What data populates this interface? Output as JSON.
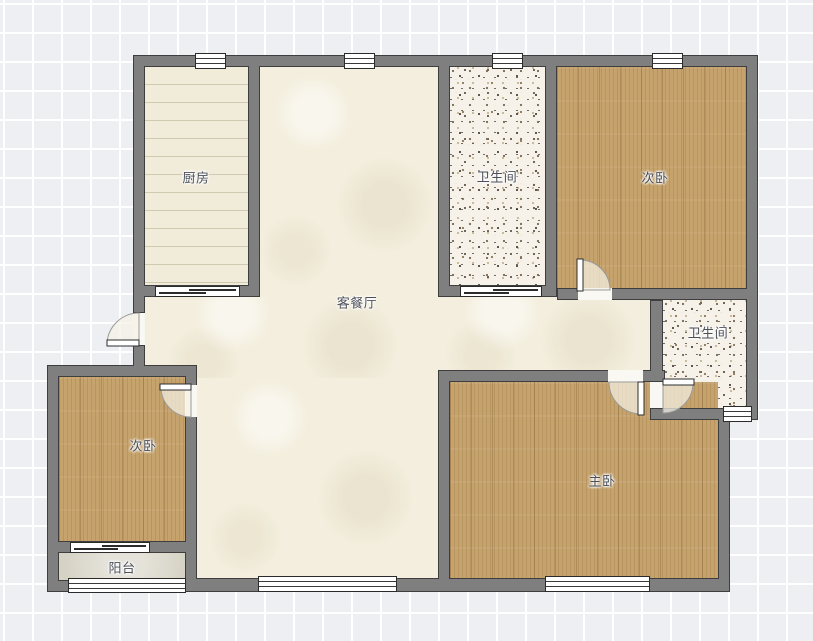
{
  "plan": {
    "title": "floor-plan",
    "rooms": [
      {
        "id": "kitchen",
        "label": "厨房"
      },
      {
        "id": "bathroom-top",
        "label": "卫生间"
      },
      {
        "id": "bedroom-top-right",
        "label": "次卧"
      },
      {
        "id": "living-dining",
        "label": "客餐厅"
      },
      {
        "id": "bathroom-right",
        "label": "卫生间"
      },
      {
        "id": "bedroom-left",
        "label": "次卧"
      },
      {
        "id": "master-bedroom",
        "label": "主卧"
      },
      {
        "id": "balcony",
        "label": "阳台"
      }
    ],
    "colors": {
      "wall": "#7f7f7f",
      "wall_outline": "#3e3e3e",
      "wood_floor": "#c6a36c",
      "kitchen_floor": "#f1ecda",
      "living_floor": "#f3eedd",
      "terrazzo_floor": "#f6f2ea",
      "balcony_floor": "#d6d3c5",
      "label_text": "#4b5058",
      "grid_background": "#edeff3"
    }
  }
}
